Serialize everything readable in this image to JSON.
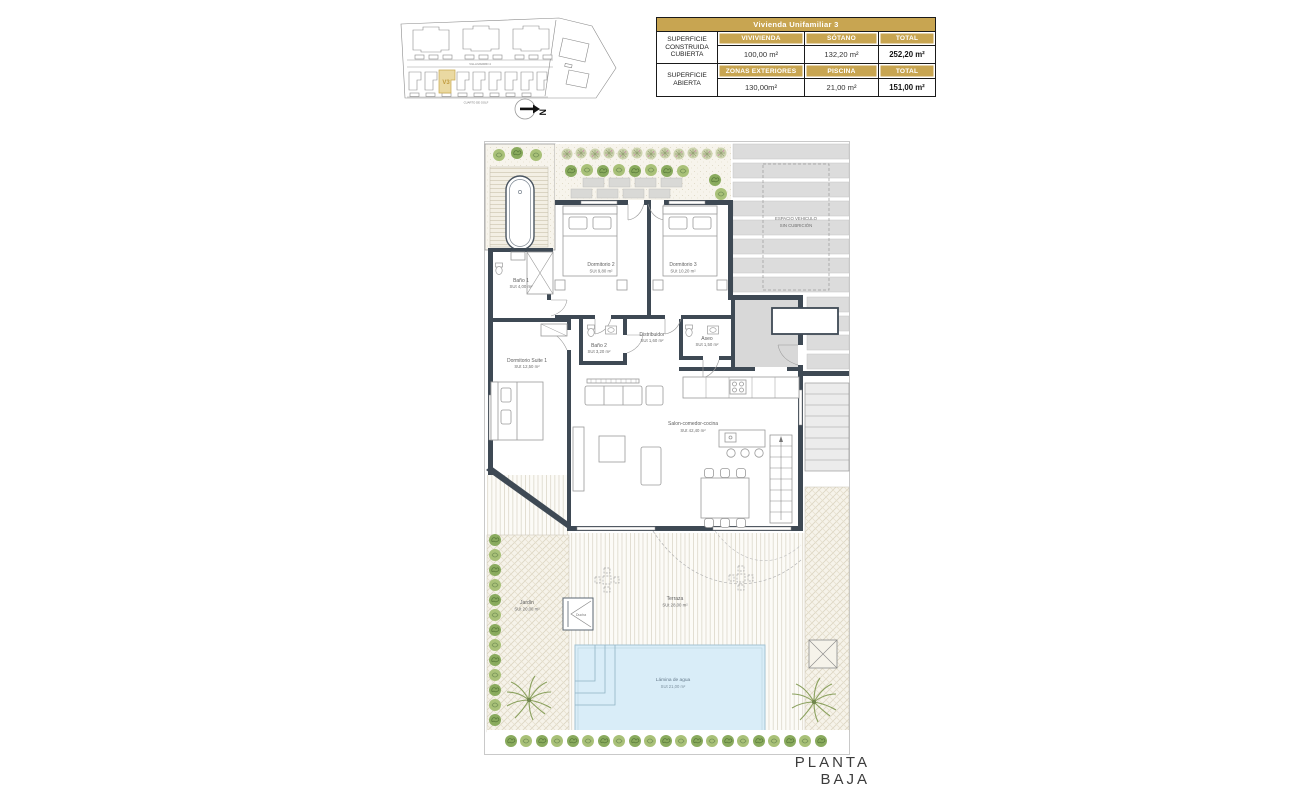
{
  "summary_table": {
    "title": "Vivienda Unifamiliar 3",
    "accent_color": "#c8a551",
    "rows": [
      {
        "section": "SUPERFICIE\nCONSTRUIDA\nCUBIERTA",
        "headers": [
          "VIVIVIENDA",
          "SÓTANO",
          "TOTAL"
        ],
        "values": [
          "100,00 m²",
          "132,20 m²",
          "252,20 m²"
        ]
      },
      {
        "section": "SUPERFICIE\nABIERTA",
        "headers": [
          "ZONAS EXTERIORES",
          "PISCINA",
          "TOTAL"
        ],
        "values": [
          "130,00m²",
          "21,00 m²",
          "151,00 m²"
        ]
      }
    ]
  },
  "site_plan": {
    "street_top": "VILLA MADRID 4",
    "street_bottom": "CUARTO DE GOLF",
    "unit_label": "V3",
    "north_label": "N",
    "highlight_color": "#ead9a2"
  },
  "floor_plan": {
    "wall_color": "#3e4954",
    "pool_color": "#d9edf8",
    "rooms": [
      {
        "name": "Baño 1",
        "area": "SUt 4,00 m²"
      },
      {
        "name": "Dormitorio 2",
        "area": "SUt 9,80 m²"
      },
      {
        "name": "Dormitorio 3",
        "area": "SUt 10,20 m²"
      },
      {
        "name": "Baño 2",
        "area": "SUt 3,20 m²"
      },
      {
        "name": "Distribuidor",
        "area": "SUt 1,60 m²"
      },
      {
        "name": "Aseo",
        "area": "SUt 1,50 m²"
      },
      {
        "name": "Dormitorio Suite 1",
        "area": "SUt 12,50 m²"
      },
      {
        "name": "Salon-comedor-cocina",
        "area": "SUt 42,40 m²"
      },
      {
        "name": "Terraza",
        "area": "SUt 28,00 m²"
      },
      {
        "name": "Jardín",
        "area": "SUt 20,00 m²"
      },
      {
        "name": "Lámina de agua",
        "area": "SUt 21,00 m²"
      }
    ],
    "vehicle_space": {
      "line1": "ESPACIO VEHICULO",
      "line2": "SIN CUBRICIÓN"
    },
    "shower_label": "Ducha"
  },
  "footer": {
    "label": "PLANTA BAJA"
  }
}
